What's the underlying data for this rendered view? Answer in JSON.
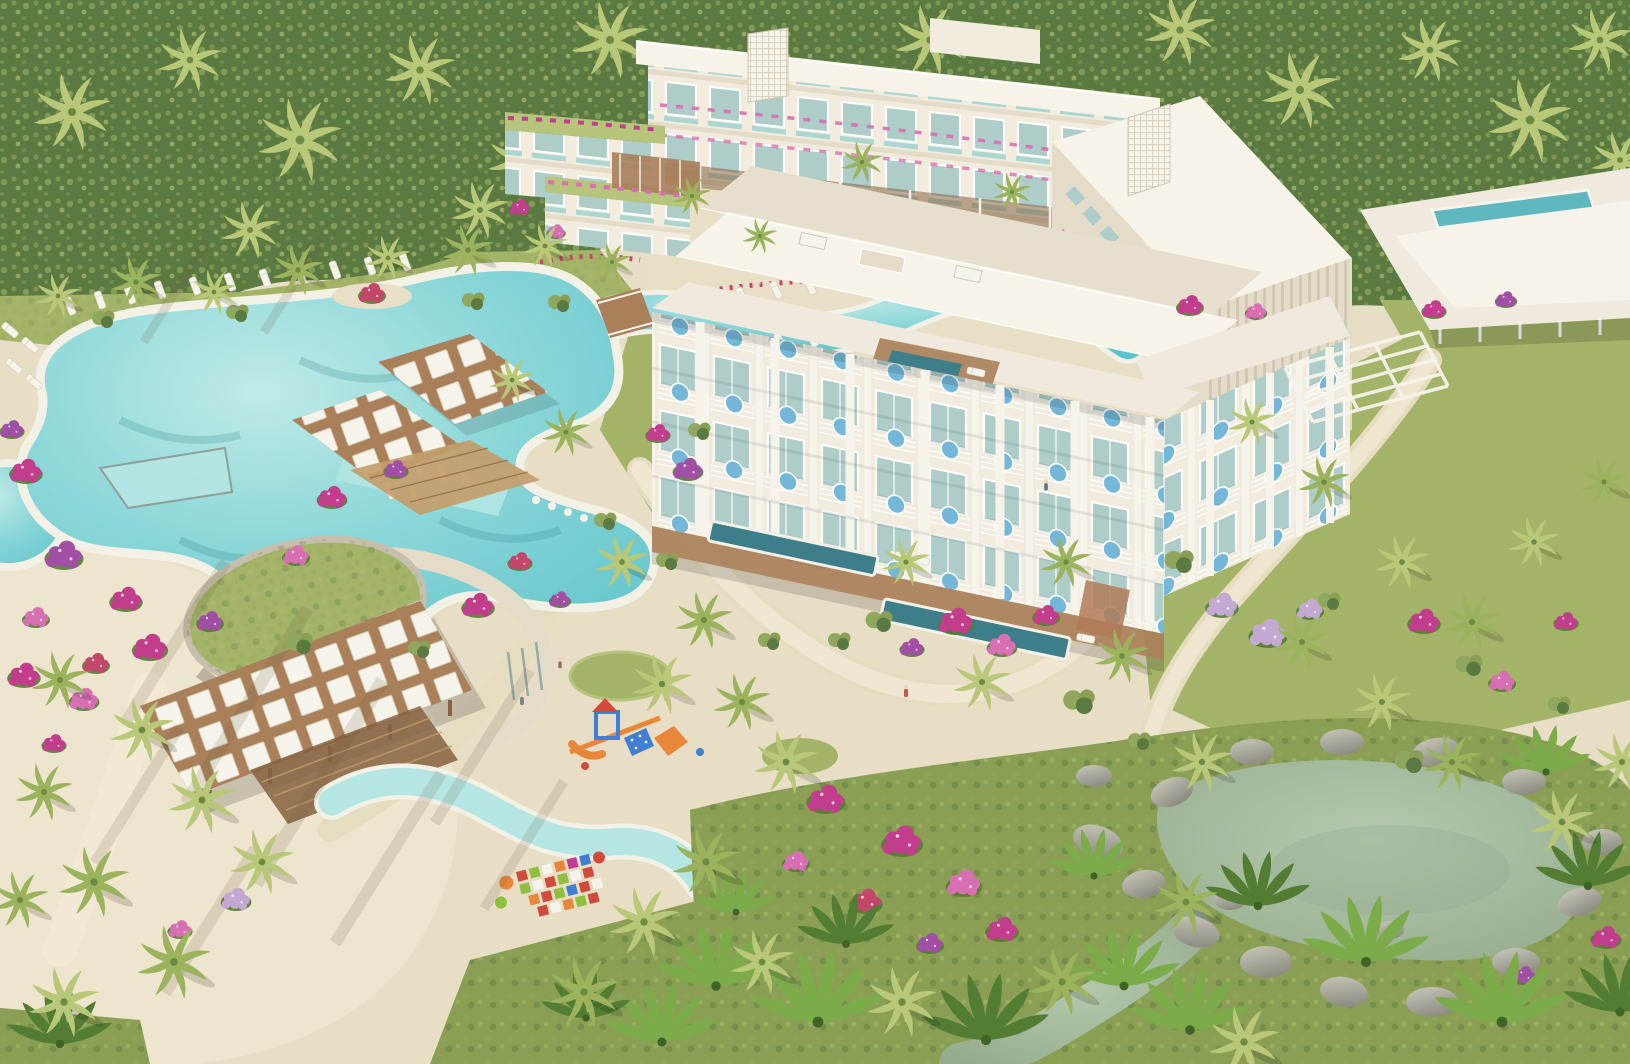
{
  "scene": {
    "title": "Aerial rendering of a tropical beach resort with pools, gardens and hotel buildings",
    "description": "3D architectural visualization viewed from above: cream hotel blocks with balconies and round blue hanging chairs, lagoon swimming pool with lazy river and wooden bridge, pergolas with white shade panels, round pavilion with green roof and pink accent wall, kids pool, playground and colorful splash pad on white sand, palm trees, magenta bougainvillea and a rock-edged pond in dense tropical forest.",
    "features": [
      "forest-backdrop",
      "palm-trees",
      "bougainvillea-bushes",
      "lagoon-pool",
      "lazy-river",
      "wooden-bridge",
      "in-pool-loungers",
      "infinity-edge",
      "swim-up-bar-pergolas",
      "beach-pergola-with-white-shade-panels",
      "round-pavilion-green-roof",
      "pink-accent-wall",
      "kids-pool",
      "splash-pad-mosaic",
      "playground",
      "sun-lounger-rows",
      "sandy-beach",
      "main-hotel-building-with-balcony-chairs",
      "ground-floor-lap-pools",
      "north-hotel-block",
      "lattice-elevator-towers",
      "rooftop-pool-building",
      "garden-pathways",
      "rock-lined-pond",
      "tropical-garden",
      "people-walking"
    ]
  },
  "palette": {
    "sand": "#e8dec6",
    "sandLight": "#f2ead6",
    "deck": "#e9dfc6",
    "pathC": "#e6dcc0",
    "grass": "#a3b368",
    "grassLight": "#b6c47c",
    "grassDark": "#8a9f54",
    "forest": "#5b7a42",
    "forestLight": "#8fa75e",
    "pool": "#82cfd3",
    "poolLight": "#b5e6e3",
    "poolDeep": "#57bdc5",
    "poolEdge": "#f3f0e6",
    "pond": "#a9bda2",
    "pondDeep": "#92a98b",
    "wall": "#f2ecdf",
    "wallShade": "#e4dcc9",
    "roof": "#efeadd",
    "roofBright": "#f7f3e9",
    "roofShade": "#e6dfcd",
    "glass": "#aecdc9",
    "glassDark": "#7fa19d",
    "wood": "#a9805a",
    "woodDark": "#86623f",
    "panel": "#f6f3ea",
    "railTeal": "#9fd2cf",
    "chairBlue": "#74b7d8",
    "lapPool": "#3d7e8a",
    "tealPool": "#5fb7bf",
    "magenta": "#c23e8d",
    "magentaLight": "#d86fb2",
    "purple": "#a14fa5",
    "lilac": "#c3a8d1",
    "pinkWall": "#d783cf",
    "redFlower": "#c4476b",
    "playOrange": "#e8873a",
    "playBlue": "#3f7fd4",
    "playRed": "#d14b3c",
    "playGreen": "#8fbf3e",
    "rock": "#98978b",
    "rockLight": "#c3c2b6",
    "trunk": "#c8b697",
    "palmLight": "#b9c878",
    "palmMid": "#9cb35e",
    "leafBright": "#7cab4a",
    "leafDark": "#527d33",
    "shadow": "#6b5a40"
  }
}
